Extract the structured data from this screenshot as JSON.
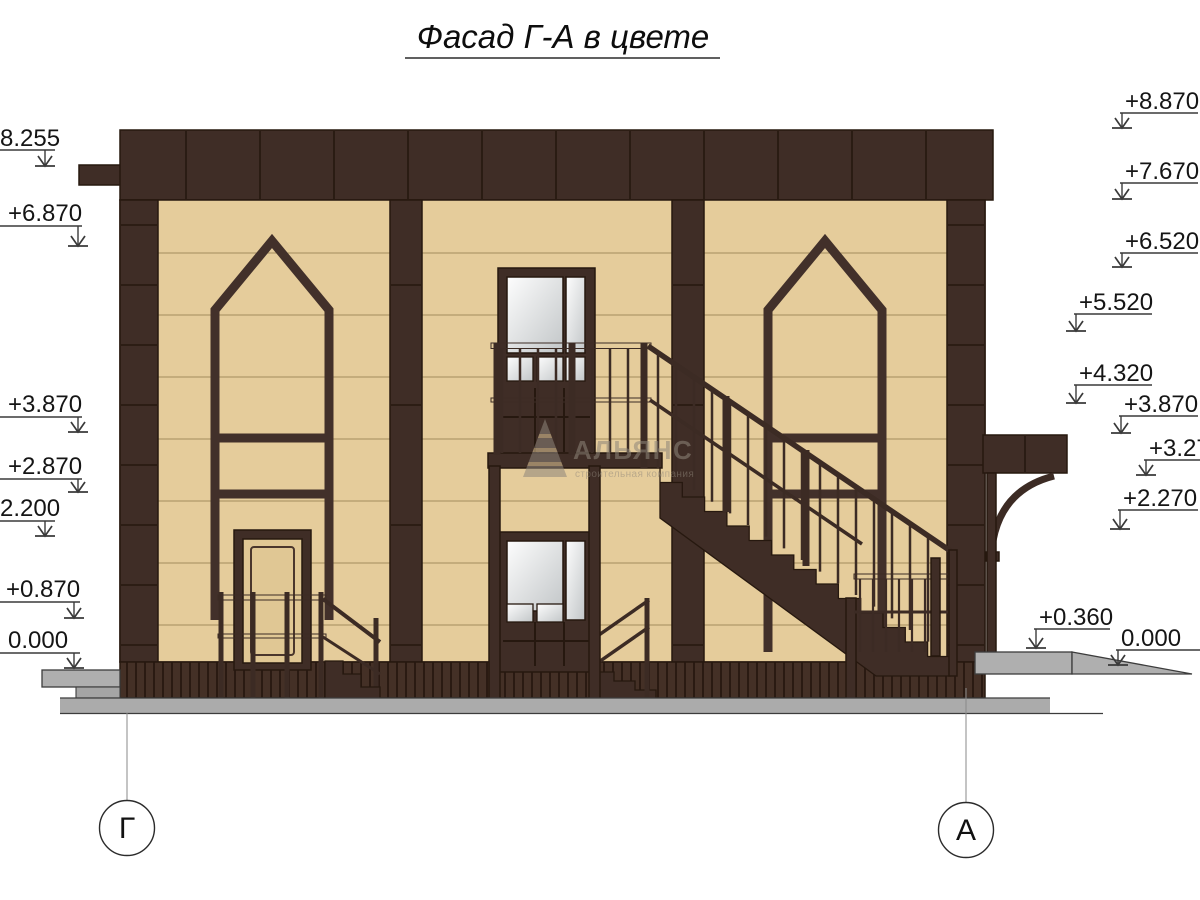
{
  "title": "Фасад Г-А в цвете",
  "elevation_marks": {
    "left": [
      "+8.255",
      "+6.870",
      "+3.870",
      "+2.870",
      "+2.200",
      "+0.870",
      "0.000"
    ],
    "right": [
      "+8.870",
      "+7.670",
      "+6.520",
      "+5.520",
      "+4.320",
      "+3.870",
      "+3.270",
      "+2.270",
      "+0.360",
      "0.000"
    ]
  },
  "axes": {
    "left": "Г",
    "right": "А"
  },
  "watermark": {
    "name": "АЛЬЯНС",
    "tagline": "строительная компания"
  },
  "colors": {
    "trim_brown": "#3F2D26",
    "wall_tan": "#E5CC9B",
    "plinth_brown": "#44302​6",
    "glass_light": "#F7F8F8",
    "ground_gray": "#AFAFAF",
    "line_dark": "#26180F"
  }
}
